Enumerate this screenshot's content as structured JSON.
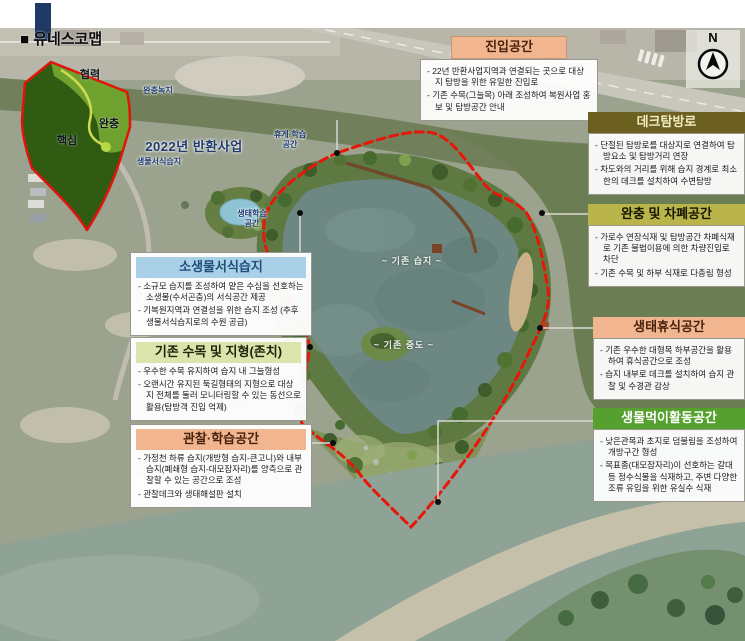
{
  "page": {
    "title": "■ 유네스코맵"
  },
  "compass": {
    "label": "N"
  },
  "inset_map": {
    "labels": {
      "cooperation": "협력",
      "buffer": "완충",
      "core": "핵심"
    }
  },
  "map_labels": {
    "buffer_green": "완충녹지",
    "return_project_2022": "2022년 반환사업",
    "bio_habitat_wetland": "생물서식습지",
    "rest_learning_line1": "휴게·학습",
    "rest_learning_line2": "공간",
    "eco_learning_line1": "생태학습",
    "eco_learning_line2": "공간",
    "existing_wetland": "~ 기존 습지 ~",
    "existing_mid_island": "~ 기존 중도 ~"
  },
  "callouts": {
    "entry": {
      "title": "진입공간",
      "bullets": [
        "- 22년 반환사업지역과 연결되는 곳으로 대상지 탐방을 위한 유일한 진입로",
        "- 기존 수목(그늘목) 아래 조성하여 복원사업 홍보 및 탐방공간 안내"
      ]
    },
    "deck_trail": {
      "title": "데크탐방로",
      "bullets": [
        "- 단절된 탐방로를 대상지로 연결하여 탐방요소 및 탐방거리 연장",
        "- 차도와의 거리를 위해 습지 경계로 최소한의 데크를 설치하여 수변탐방"
      ]
    },
    "buffer_screen": {
      "title": "완충 및 차폐공간",
      "bullets": [
        "- 가로수 연장식재 및 탐방공간 차폐식재로 기존 불법이용에 의한 차량진입로 차단",
        "- 기존 수목 및 하부 식재로 다층림 형성"
      ]
    },
    "eco_rest": {
      "title": "생태휴식공간",
      "bullets": [
        "- 기존 우수한 대형목 하부공간을 활용하여 휴식공간으로 조성",
        "- 습지 내부로 데크를 설치하여 습지 관찰 및 수경관 감상"
      ]
    },
    "feeding": {
      "title": "생물먹이활동공간",
      "bullets": [
        "- 낮은관목과 초지로 덤불림을 조성하여 개방구간 형성",
        "- 목표종(대모잠자리)이 선호하는 갈대 등 정수식물을 식재하고, 주변 다양한 조류 유입을 위한 유실수 식재"
      ]
    },
    "small_habitat": {
      "title": "소생물서식습지",
      "bullets": [
        "- 소규모 습지를 조성하여 얕은 수심을 선호하는 소생물(수서곤충)의 서식공간 제공",
        "- 기복원지역과 연결성을 위한 습지 조성 (추후 생물서식습지로의 수원 공급)"
      ]
    },
    "existing_trees": {
      "title": "기존 수목 및 지형(존치)",
      "bullets": [
        "- 우수한 수목 유지하여 습지 내 그늘형성",
        "- 오랜시간 유지된 둑길형태의 지형으로 대상지 전체를 둘러 모니터링할 수 있는 동선으로 활용(탐방객 진입 억제)"
      ]
    },
    "observe_learn": {
      "title": "관찰·학습공간",
      "bullets": [
        "- 가정천 하류 습지(개방형 습지-큰고니)와 내부 습지(폐쇄형 습지-대모잠자리)를 양측으로 관찰할 수 있는 공간으로 조성",
        "- 관찰데크와 생태해설판 설치"
      ]
    }
  },
  "colors": {
    "boundary_red": "#e81609",
    "title_peach": "#f1b68f",
    "title_dark_olive": "#6b6020",
    "title_olive_yellow": "#b9b54b",
    "title_green": "#55a02e",
    "title_light_blue": "#aad0e8",
    "title_pale_green": "#dde3ac",
    "logo_navy": "#1f3864",
    "inset_core_green": "#2f5b13",
    "inset_buffer_green": "#6fa12f"
  }
}
